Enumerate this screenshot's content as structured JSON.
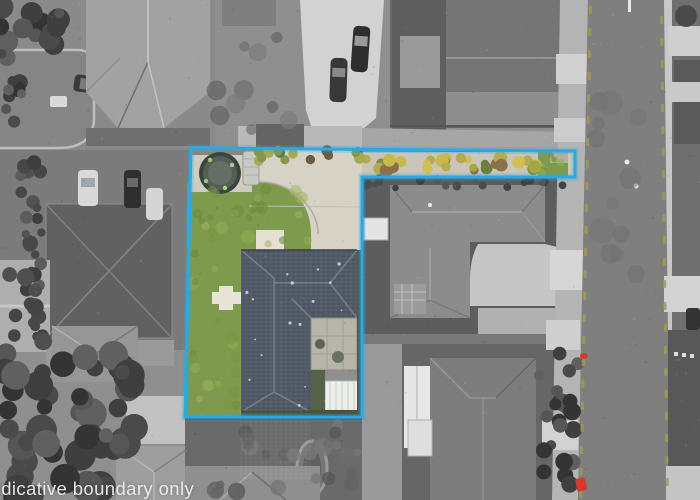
{
  "watermark": {
    "text": "Indicative boundary only",
    "visible_text": "dicative boundary only"
  },
  "boundary_overlay": {
    "color": "#2BA9E2",
    "style": "solid polygon outline",
    "shape": "L-shaped parcel with narrow access strip to street"
  },
  "scene": {
    "type": "aerial-photograph",
    "style": "grayscale neighbourhood with the subject property shown in colour inside a blue indicative boundary",
    "features": [
      "subject house with dark slate hip roof",
      "green lawn",
      "concrete courtyard and driveway",
      "trampoline",
      "water tank",
      "white greenhouse",
      "paved patio",
      "yellow-green hedge strip along shared driveway to street",
      "neighbouring grey-roof houses",
      "vertical street with yellow edge markings and white centre markers",
      "red letterbox markers beside street",
      "tree canopy at lower left"
    ]
  },
  "palette": {
    "boundary_blue": "#2BA9E2",
    "lawn_green": "#7E9A4C",
    "roof_slate": "#4D5662",
    "concrete_warm": "#D6D2C5",
    "hedge_yellow": "#C2B04A",
    "asphalt_gray": "#7F7F7F",
    "curb_concrete": "#C7C7C7",
    "road_marking_yellow": "#A39952",
    "marker_red": "#D23A2C",
    "greenhouse_white": "#ECEEE9"
  }
}
